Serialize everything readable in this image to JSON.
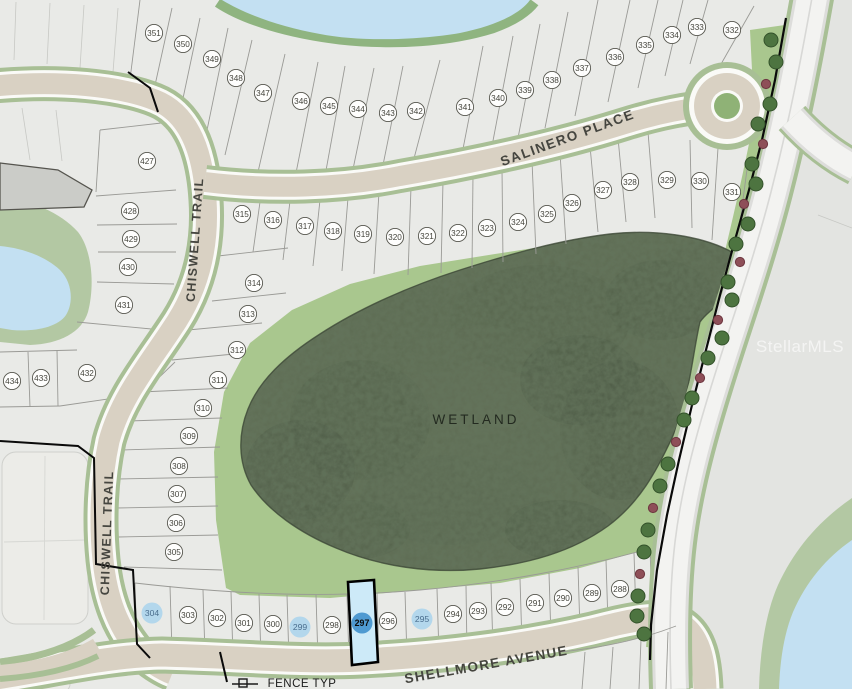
{
  "map": {
    "watermark": "StellarMLS",
    "street_labels": [
      {
        "text": "SALINERO PLACE",
        "x": 569,
        "y": 142,
        "rotate": -20,
        "size": 13.5,
        "ls": 1.6,
        "w": 700
      },
      {
        "text": "CHISWELL TRAIL",
        "x": 199,
        "y": 240,
        "rotate": -86,
        "size": 12.5,
        "ls": 1.4,
        "w": 700
      },
      {
        "text": "CHISWELL TRAIL",
        "x": 111,
        "y": 533,
        "rotate": -88,
        "size": 12.5,
        "ls": 1.4,
        "w": 700
      },
      {
        "text": "SHELLMORE AVENUE",
        "x": 487,
        "y": 669,
        "rotate": -10,
        "size": 13.5,
        "ls": 1.4,
        "w": 700
      }
    ],
    "area_labels": [
      {
        "text": "WETLAND",
        "x": 476,
        "y": 424,
        "size": 13.5,
        "ls": 3,
        "fill": "#232a20"
      }
    ],
    "notes": [
      {
        "text": "FENCE TYP",
        "x": 302,
        "y": 687,
        "size": 11.5,
        "fill": "#1a1a1a"
      }
    ],
    "highlight": {
      "strong_lot": "297",
      "light_lots": [
        "304",
        "299",
        "295"
      ],
      "strong_color": "#4f9ad1",
      "light_color": "#a9d3ec",
      "parcel_fill": "#cdeaf8",
      "parcel_border": "#000000"
    },
    "lot_rows": [
      {
        "name": "north-of-salinero",
        "lots": [
          {
            "n": "351",
            "x": 154,
            "y": 33
          },
          {
            "n": "350",
            "x": 183,
            "y": 44
          },
          {
            "n": "349",
            "x": 212,
            "y": 59
          },
          {
            "n": "348",
            "x": 236,
            "y": 78
          },
          {
            "n": "347",
            "x": 263,
            "y": 93
          },
          {
            "n": "346",
            "x": 301,
            "y": 101
          },
          {
            "n": "345",
            "x": 329,
            "y": 106
          },
          {
            "n": "344",
            "x": 358,
            "y": 109
          },
          {
            "n": "343",
            "x": 388,
            "y": 113
          },
          {
            "n": "342",
            "x": 416,
            "y": 111
          },
          {
            "n": "341",
            "x": 465,
            "y": 107
          },
          {
            "n": "340",
            "x": 498,
            "y": 98
          },
          {
            "n": "339",
            "x": 525,
            "y": 90
          },
          {
            "n": "338",
            "x": 552,
            "y": 80
          },
          {
            "n": "337",
            "x": 582,
            "y": 68
          },
          {
            "n": "336",
            "x": 615,
            "y": 57
          },
          {
            "n": "335",
            "x": 645,
            "y": 45
          },
          {
            "n": "334",
            "x": 672,
            "y": 35
          },
          {
            "n": "333",
            "x": 697,
            "y": 27
          },
          {
            "n": "332",
            "x": 732,
            "y": 30
          }
        ]
      },
      {
        "name": "south-of-salinero",
        "lots": [
          {
            "n": "316",
            "x": 273,
            "y": 220
          },
          {
            "n": "317",
            "x": 305,
            "y": 226
          },
          {
            "n": "318",
            "x": 333,
            "y": 231
          },
          {
            "n": "319",
            "x": 363,
            "y": 234
          },
          {
            "n": "320",
            "x": 395,
            "y": 237
          },
          {
            "n": "321",
            "x": 427,
            "y": 236
          },
          {
            "n": "322",
            "x": 458,
            "y": 233
          },
          {
            "n": "323",
            "x": 487,
            "y": 228
          },
          {
            "n": "324",
            "x": 518,
            "y": 222
          },
          {
            "n": "325",
            "x": 547,
            "y": 214
          },
          {
            "n": "326",
            "x": 572,
            "y": 203
          },
          {
            "n": "327",
            "x": 603,
            "y": 190
          },
          {
            "n": "328",
            "x": 630,
            "y": 182
          },
          {
            "n": "329",
            "x": 667,
            "y": 180
          },
          {
            "n": "330",
            "x": 700,
            "y": 181
          },
          {
            "n": "331",
            "x": 732,
            "y": 192
          }
        ]
      },
      {
        "name": "west-of-chiswell",
        "lots": [
          {
            "n": "427",
            "x": 147,
            "y": 161
          },
          {
            "n": "428",
            "x": 130,
            "y": 211
          },
          {
            "n": "429",
            "x": 131,
            "y": 239
          },
          {
            "n": "430",
            "x": 128,
            "y": 267
          },
          {
            "n": "431",
            "x": 124,
            "y": 305
          },
          {
            "n": "432",
            "x": 87,
            "y": 373
          },
          {
            "n": "433",
            "x": 41,
            "y": 378
          },
          {
            "n": "434",
            "x": 12,
            "y": 381
          }
        ]
      },
      {
        "name": "east-of-chiswell",
        "lots": [
          {
            "n": "315",
            "x": 242,
            "y": 214
          },
          {
            "n": "314",
            "x": 254,
            "y": 283
          },
          {
            "n": "313",
            "x": 248,
            "y": 314
          },
          {
            "n": "312",
            "x": 237,
            "y": 350
          },
          {
            "n": "311",
            "x": 218,
            "y": 380
          },
          {
            "n": "310",
            "x": 203,
            "y": 408
          },
          {
            "n": "309",
            "x": 189,
            "y": 436
          },
          {
            "n": "308",
            "x": 179,
            "y": 466
          },
          {
            "n": "307",
            "x": 177,
            "y": 494
          },
          {
            "n": "306",
            "x": 176,
            "y": 523
          },
          {
            "n": "305",
            "x": 174,
            "y": 552
          }
        ]
      },
      {
        "name": "shellmore-avenue-row",
        "lots": [
          {
            "n": "304",
            "x": 152,
            "y": 613,
            "mark": "light"
          },
          {
            "n": "303",
            "x": 188,
            "y": 615
          },
          {
            "n": "302",
            "x": 217,
            "y": 618
          },
          {
            "n": "301",
            "x": 244,
            "y": 623
          },
          {
            "n": "300",
            "x": 273,
            "y": 624
          },
          {
            "n": "299",
            "x": 300,
            "y": 627,
            "mark": "light"
          },
          {
            "n": "298",
            "x": 332,
            "y": 625
          },
          {
            "n": "297",
            "x": 362,
            "y": 623,
            "mark": "strong"
          },
          {
            "n": "296",
            "x": 388,
            "y": 621
          },
          {
            "n": "295",
            "x": 422,
            "y": 619,
            "mark": "light"
          },
          {
            "n": "294",
            "x": 453,
            "y": 614
          },
          {
            "n": "293",
            "x": 478,
            "y": 611
          },
          {
            "n": "292",
            "x": 505,
            "y": 607
          },
          {
            "n": "291",
            "x": 535,
            "y": 603
          },
          {
            "n": "290",
            "x": 563,
            "y": 598
          },
          {
            "n": "289",
            "x": 592,
            "y": 593
          },
          {
            "n": "288",
            "x": 620,
            "y": 589
          }
        ]
      }
    ],
    "trees": [
      {
        "x": 771,
        "y": 40,
        "t": "green"
      },
      {
        "x": 776,
        "y": 62,
        "t": "green"
      },
      {
        "x": 766,
        "y": 84,
        "t": "red"
      },
      {
        "x": 770,
        "y": 104,
        "t": "green"
      },
      {
        "x": 758,
        "y": 124,
        "t": "green"
      },
      {
        "x": 763,
        "y": 144,
        "t": "red"
      },
      {
        "x": 752,
        "y": 164,
        "t": "green"
      },
      {
        "x": 756,
        "y": 184,
        "t": "green"
      },
      {
        "x": 744,
        "y": 204,
        "t": "red"
      },
      {
        "x": 748,
        "y": 224,
        "t": "green"
      },
      {
        "x": 736,
        "y": 244,
        "t": "green"
      },
      {
        "x": 740,
        "y": 262,
        "t": "red"
      },
      {
        "x": 728,
        "y": 282,
        "t": "green"
      },
      {
        "x": 732,
        "y": 300,
        "t": "green"
      },
      {
        "x": 718,
        "y": 320,
        "t": "red"
      },
      {
        "x": 722,
        "y": 338,
        "t": "green"
      },
      {
        "x": 708,
        "y": 358,
        "t": "green"
      },
      {
        "x": 700,
        "y": 378,
        "t": "red"
      },
      {
        "x": 692,
        "y": 398,
        "t": "green"
      },
      {
        "x": 684,
        "y": 420,
        "t": "green"
      },
      {
        "x": 676,
        "y": 442,
        "t": "red"
      },
      {
        "x": 668,
        "y": 464,
        "t": "green"
      },
      {
        "x": 660,
        "y": 486,
        "t": "green"
      },
      {
        "x": 653,
        "y": 508,
        "t": "red"
      },
      {
        "x": 648,
        "y": 530,
        "t": "green"
      },
      {
        "x": 644,
        "y": 552,
        "t": "green"
      },
      {
        "x": 640,
        "y": 574,
        "t": "red"
      },
      {
        "x": 638,
        "y": 596,
        "t": "green"
      },
      {
        "x": 637,
        "y": 616,
        "t": "green"
      },
      {
        "x": 644,
        "y": 634,
        "t": "green"
      }
    ],
    "colors": {
      "ground": "#e9eae7",
      "ground_right": "#e3e4e1",
      "buffer_green": "#a9c78e",
      "wetland_base": "#5c6950",
      "road_tan": "#d9d1c3",
      "road_casing": "#fafaf7",
      "road_green": "#a8bf95",
      "arterial": "#f3f3f1",
      "water": "#c3e0f2",
      "shore_green": "#b3c8a3",
      "boundary": "#0a0a0a",
      "lot_line": "#9a9a96"
    }
  }
}
